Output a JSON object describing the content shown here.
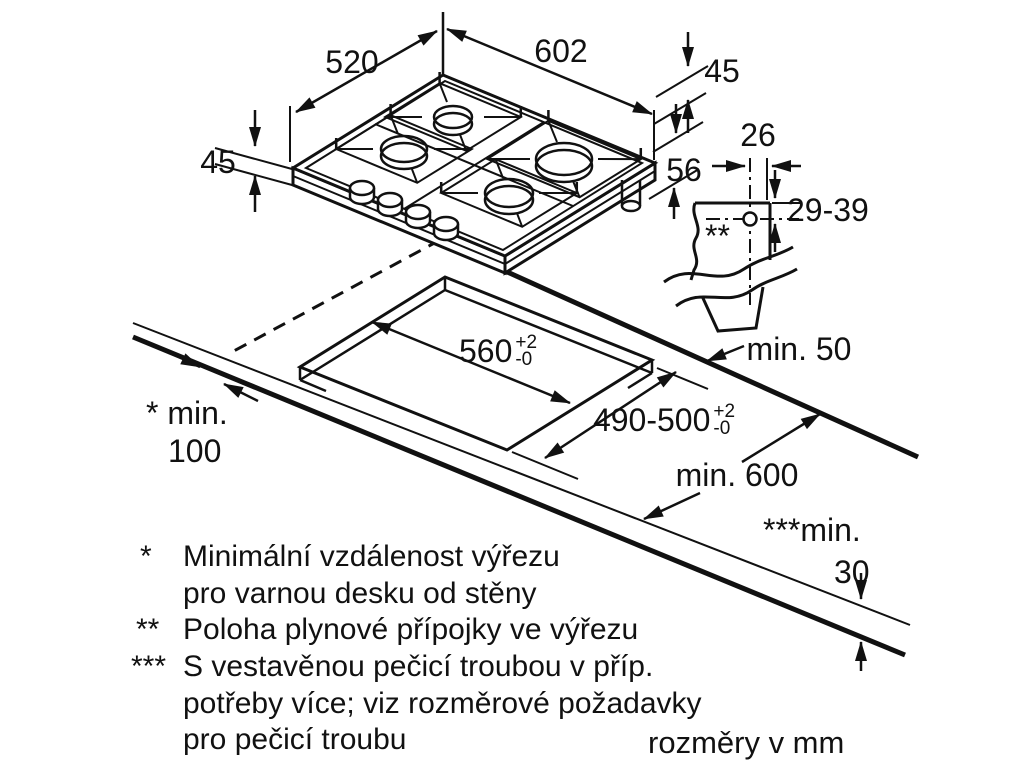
{
  "diagram": {
    "title_hidden": "",
    "units_note": "rozměry v mm",
    "dimensions": {
      "appliance_width": "602",
      "appliance_depth": "520",
      "height_above_worktop_left": "45",
      "height_above_worktop_right": "45",
      "depth_below_worktop": "56",
      "gas_connection_offset_x": "26",
      "gas_connection_offset_y": "29-39",
      "cutout_width": {
        "value": "560",
        "tol_plus": "+2",
        "tol_minus": "-0"
      },
      "cutout_depth": {
        "value": "490-500",
        "tol_plus": "+2",
        "tol_minus": "-0"
      },
      "rear_wall_clearance": "min. 50",
      "worktop_depth": "min. 600",
      "side_wall_clearance_line1": "* min.",
      "side_wall_clearance_line2": "100",
      "worktop_thickness_line1": "***min.",
      "worktop_thickness_line2": "30",
      "gas_connection_marker": "**"
    },
    "footnotes": [
      {
        "marker": "*",
        "lines": [
          "Minimální vzdálenost výřezu",
          "pro varnou desku od stěny"
        ]
      },
      {
        "marker": "**",
        "lines": [
          "Poloha plynové přípojky ve výřezu"
        ]
      },
      {
        "marker": "***",
        "lines": [
          "S vestavěnou pečicí troubou v příp.",
          "potřeby více; viz rozměrové požadavky",
          "pro pečicí troubu"
        ]
      }
    ],
    "colors": {
      "line": "#111111",
      "burner_fill": "#c9c9c9"
    }
  }
}
